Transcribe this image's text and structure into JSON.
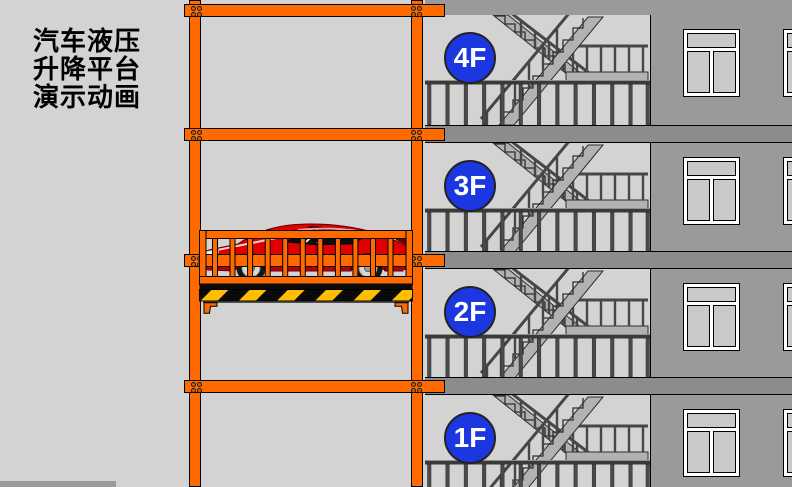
{
  "title": {
    "line1": "汽车液压",
    "line2": "升降平台",
    "line3": "演示动画"
  },
  "floors": [
    {
      "label": "4F"
    },
    {
      "label": "3F"
    },
    {
      "label": "2F"
    },
    {
      "label": "1F"
    }
  ],
  "colors": {
    "frame_orange": "#FF6A00",
    "floor_badge_blue": "#1C36E0",
    "badge_text": "#FFFFFF",
    "hazard_yellow": "#FFBE00",
    "hazard_black": "#0A0A0A",
    "car_red": "#DF0000",
    "wall_gray": "#9A9A9A",
    "slab_gray": "#8C8C8C",
    "background_gray": "#D3D3D3"
  }
}
